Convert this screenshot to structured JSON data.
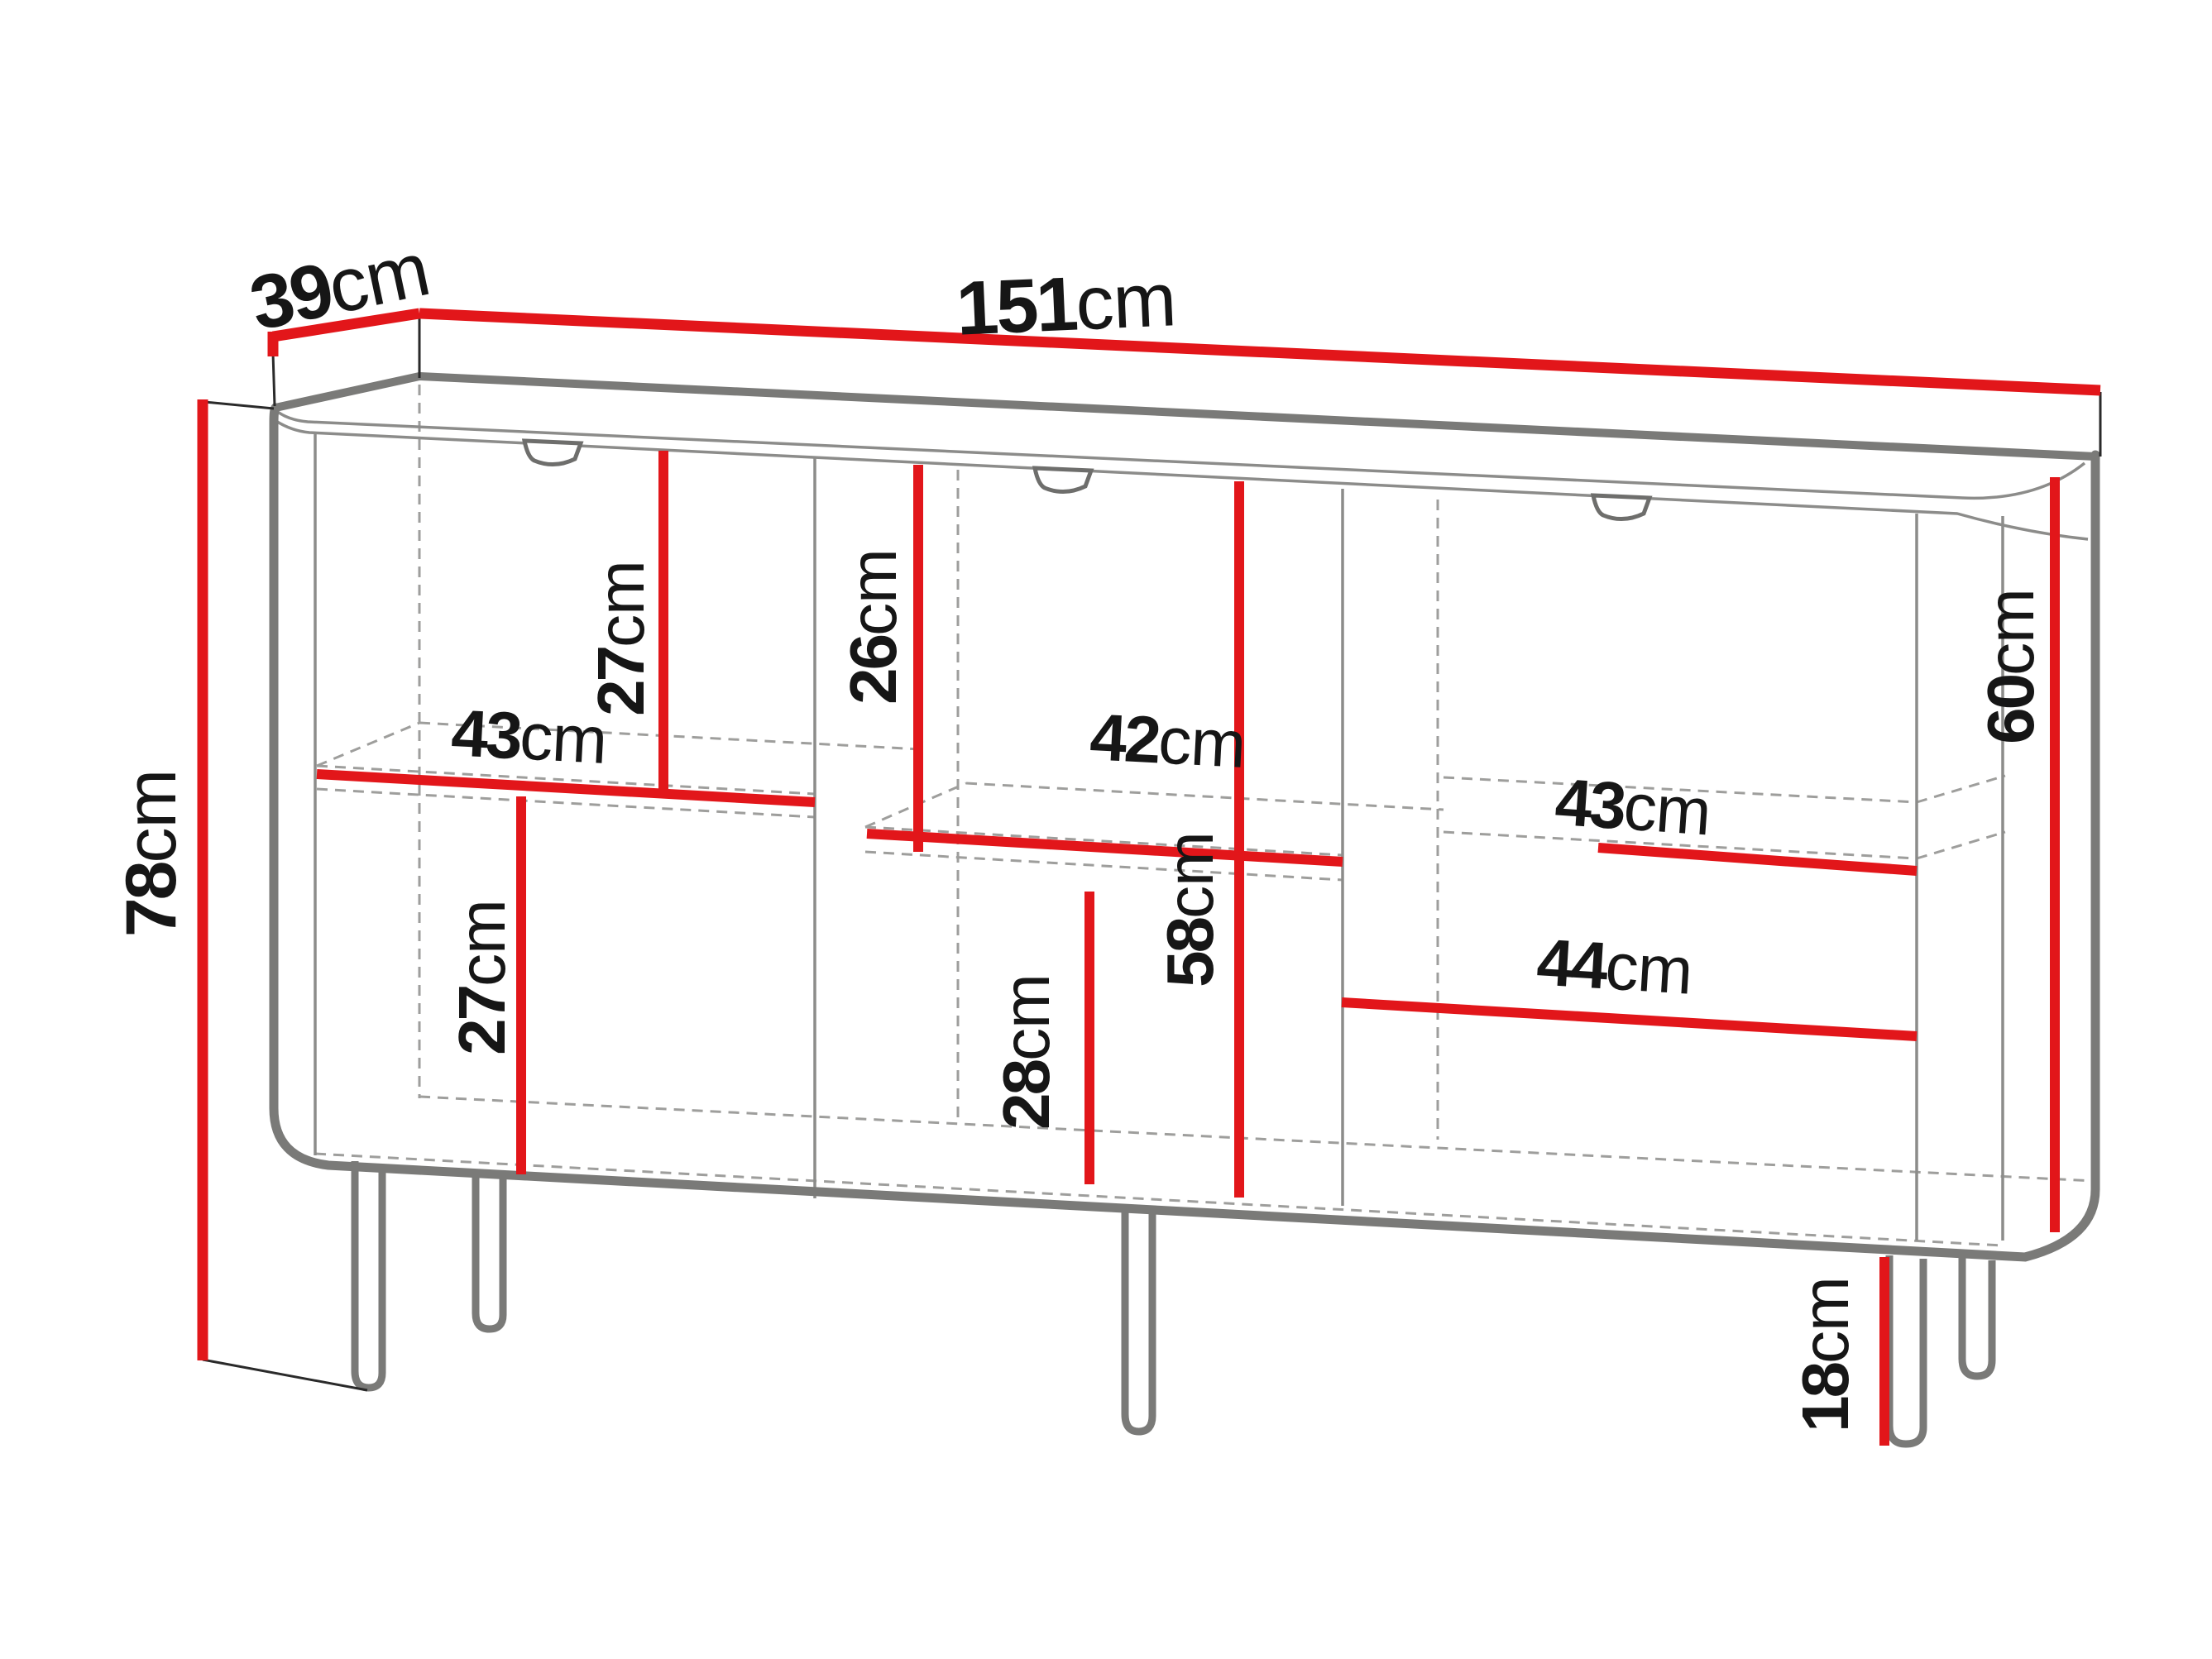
{
  "diagram": {
    "title": "Sideboard dimension diagram",
    "unit": "cm",
    "colors": {
      "dimension_line": "#e2161a",
      "outline_gray": "#7a7a78",
      "thin_line": "#8c8c8a",
      "hidden_dashed": "#9e9e9c",
      "text": "#161616",
      "background": "#ffffff"
    },
    "overall_dimensions": {
      "width_cm": 151,
      "depth_cm": 39,
      "height_cm": 78,
      "leg_height_cm": 18
    },
    "interior_dimensions": {
      "upper_left_compartment_height_cm": 27,
      "upper_middle_compartment_height_cm": 26,
      "left_shelf_width_cm": 43,
      "middle_shelf_width_cm": 42,
      "right_shelf_width_cm": 43,
      "lower_left_compartment_height_cm": 27,
      "lower_middle_compartment_height_cm": 28,
      "middle_interior_height_cm": 58,
      "right_interior_height_cm": 60,
      "right_drawer_width_cm": 44
    },
    "labels": [
      {
        "id": "depth",
        "num": "39",
        "unit": "cm"
      },
      {
        "id": "width",
        "num": "151",
        "unit": "cm"
      },
      {
        "id": "height",
        "num": "78",
        "unit": "cm"
      },
      {
        "id": "upper-left-compartment",
        "num": "27",
        "unit": "cm"
      },
      {
        "id": "upper-middle-compartment",
        "num": "26",
        "unit": "cm"
      },
      {
        "id": "left-shelf-width",
        "num": "43",
        "unit": "cm"
      },
      {
        "id": "middle-shelf-width",
        "num": "42",
        "unit": "cm"
      },
      {
        "id": "right-shelf-width",
        "num": "43",
        "unit": "cm"
      },
      {
        "id": "lower-left-compartment",
        "num": "27",
        "unit": "cm"
      },
      {
        "id": "lower-middle-compartment",
        "num": "28",
        "unit": "cm"
      },
      {
        "id": "middle-interior-height",
        "num": "58",
        "unit": "cm"
      },
      {
        "id": "right-interior-height",
        "num": "60",
        "unit": "cm"
      },
      {
        "id": "right-drawer-width",
        "num": "44",
        "unit": "cm"
      },
      {
        "id": "leg-height",
        "num": "18",
        "unit": "cm"
      }
    ]
  }
}
